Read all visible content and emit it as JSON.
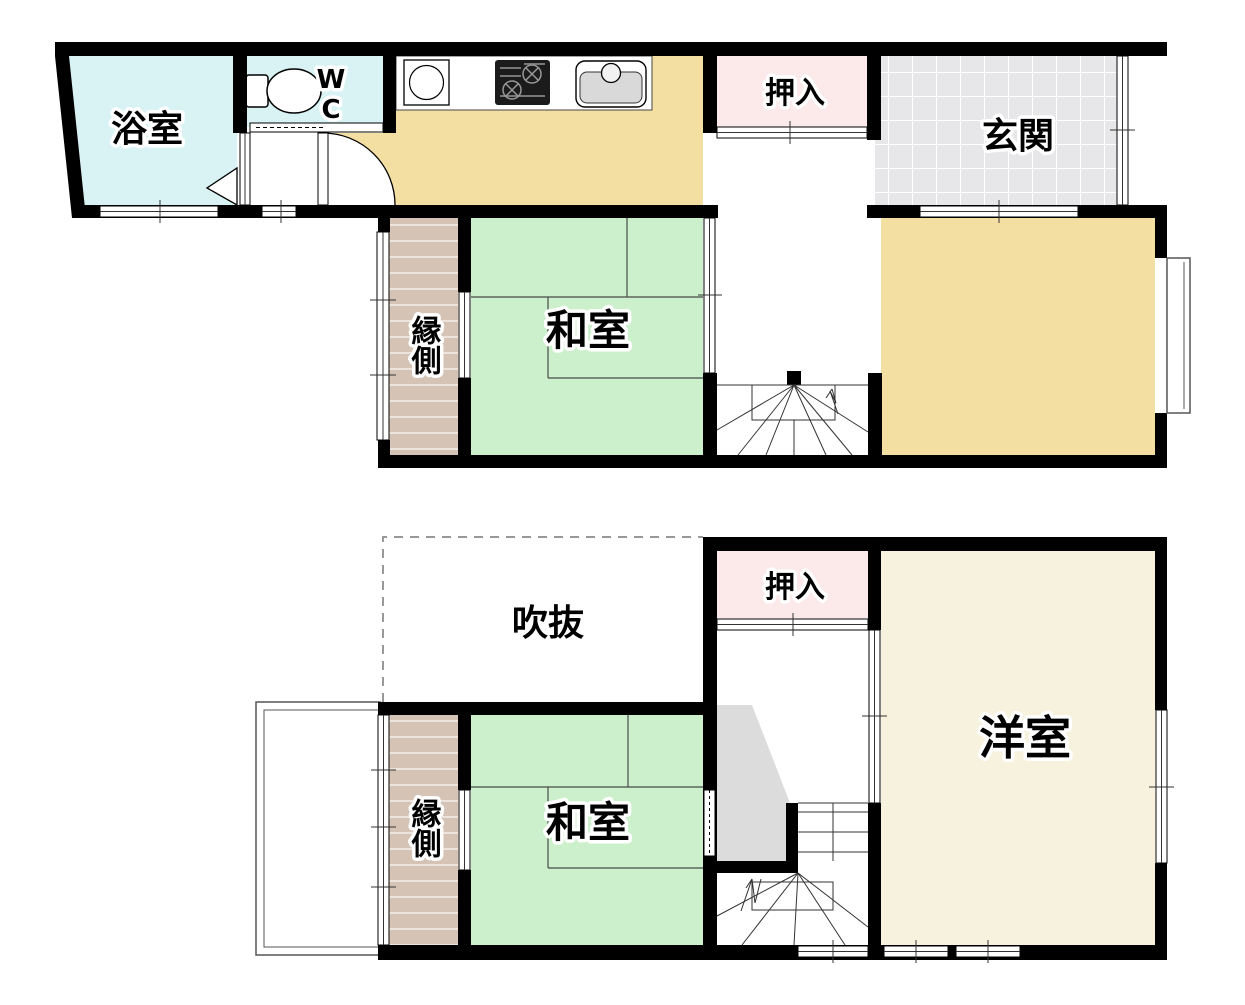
{
  "floor1": {
    "bathroom_label": "浴室",
    "wc_label_top": "W",
    "wc_label_bottom": "C",
    "closet_label": "押入",
    "entrance_label": "玄関",
    "veranda_label": "縁側",
    "washitsu_label": "和室"
  },
  "floor2": {
    "void_label": "吹抜",
    "closet_label": "押入",
    "western_label": "洋室",
    "veranda_label": "縁側",
    "washitsu_label": "和室"
  },
  "colors": {
    "bathroom": "#d9f3f5",
    "kitchen_dining": "#f4dfa3",
    "closet": "#fbeae9",
    "entrance_tile": "#e7e7e9",
    "veranda": "#d5c4b6",
    "tatami": "#cdf0cc",
    "western_room": "#f7f2de",
    "stair_shadow": "#dcdcdc",
    "wall": "#000000",
    "void_dash": "#999999"
  }
}
